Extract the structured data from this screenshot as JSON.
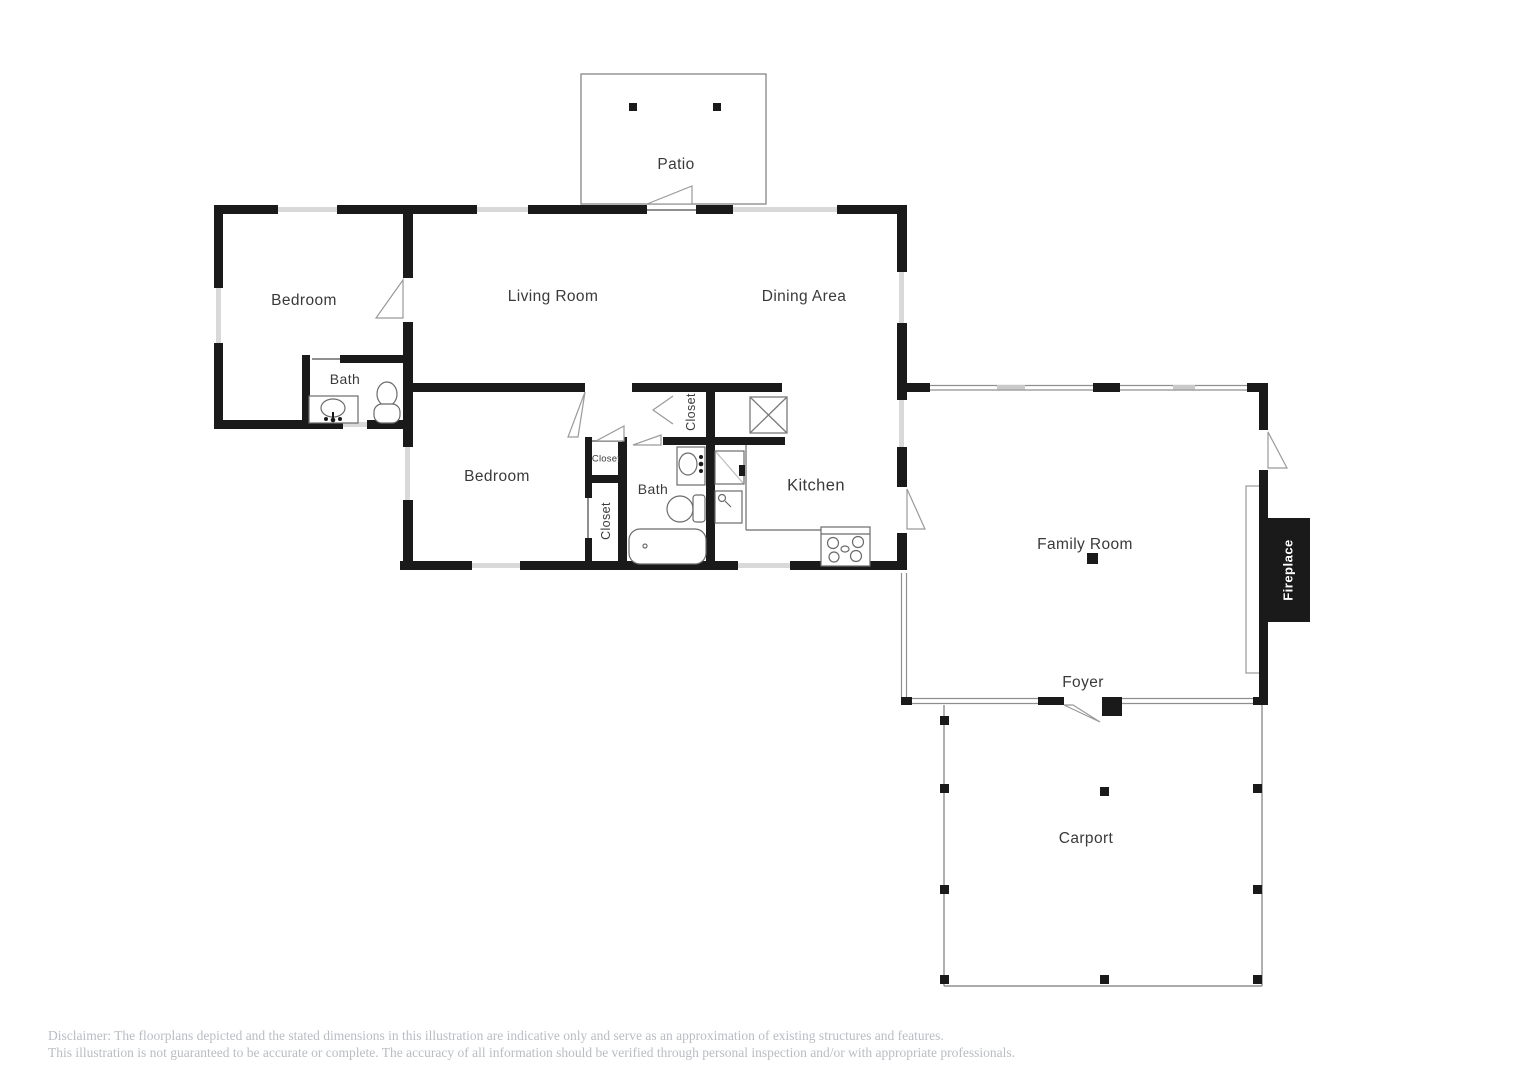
{
  "document": {
    "type": "residential-floor-plan"
  },
  "colors": {
    "background": "#ffffff",
    "wall": "#1a1a1a",
    "window_band": "#d9d9d9",
    "thin_line": "#8f8f8f",
    "fixture_stroke": "#6b6b6b",
    "label_text": "#3a3a3a",
    "fireplace_bg": "#1a1a1a",
    "fireplace_text": "#ffffff",
    "disclaimer_text": "#b9bdc3"
  },
  "labels": {
    "patio": "Patio",
    "bedroom_top": "Bedroom",
    "living_room": "Living Room",
    "dining_area": "Dining Area",
    "bath_top": "Bath",
    "bedroom_lower": "Bedroom",
    "closet_small": "Closet",
    "closet_tall": "Closet",
    "closet_center": "Closet",
    "bath_lower": "Bath",
    "kitchen": "Kitchen",
    "family_room": "Family Room",
    "fireplace": "Fireplace",
    "foyer": "Foyer",
    "carport": "Carport"
  },
  "fixtures": [
    "bathroom-sink",
    "toilet",
    "bathtub",
    "kitchen-sink",
    "prep-sink",
    "stove",
    "washer-box",
    "fireplace",
    "hearth",
    "patio-post",
    "carport-post"
  ],
  "disclaimer": {
    "line1": "Disclaimer: The floorplans depicted and the stated dimensions in this illustration are indicative only and serve as an approximation of existing structures and features.",
    "line2": "This illustration is not guaranteed to be accurate or complete. The accuracy of all information should be verified through personal inspection and/or with appropriate professionals."
  }
}
